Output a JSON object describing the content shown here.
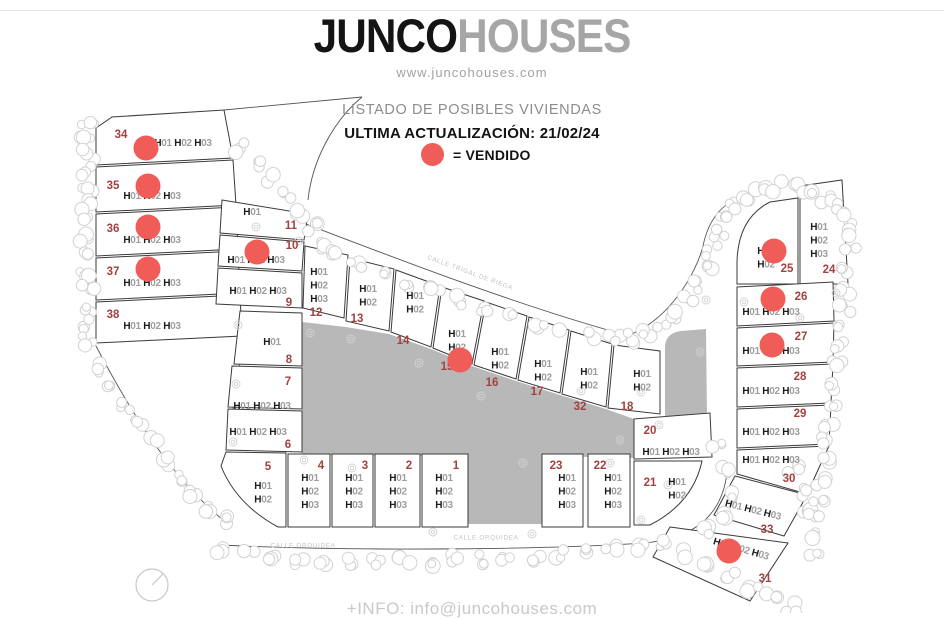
{
  "header": {
    "logo_primary": "JUNCO",
    "logo_secondary": "HOUSES",
    "website": "www.juncohouses.com",
    "listing_title": "LISTADO DE POSIBLES VIVIENDAS",
    "last_update": "ULTIMA ACTUALIZACIÓN: 21/02/24",
    "legend_label": "= VENDIDO"
  },
  "footer": {
    "info_text": "+INFO: info@juncohouses.com"
  },
  "colors": {
    "sold_dot": "#f05c57",
    "plot_number": "#a24140",
    "label_h": "#1b1b1b",
    "label_digits": "#9e9e9e",
    "outline": "#3a3a3a",
    "gray_area": "#b8b8b8",
    "trees": "#d2d2d2",
    "street": "#c2c2c2",
    "road": "#555555"
  },
  "map": {
    "street_labels": [
      {
        "text": "CALLE TRIGAL DE RIEGA",
        "x": 470,
        "y": 273,
        "rotate": 20
      },
      {
        "text": "CALLE ORQUIDEA",
        "x": 303,
        "y": 546,
        "rotate": 0
      },
      {
        "text": "CALLE ORQUIDEA",
        "x": 486,
        "y": 538,
        "rotate": 0
      }
    ],
    "gray_areas": [
      "M302,322 L346,327 L389,334 L431,349 L472,366 L516,381 L560,395 L606,409 L634,419 L634,458 L542,456 L542,524 L468,524 L468,456 L302,455 Z",
      "M665,346 Q666,333 681,331 L706,329 L707,416 L665,416 Z"
    ],
    "compass": {
      "cx": 152,
      "cy": 585,
      "r": 16
    },
    "plots": [
      {
        "n": "34",
        "houses": [
          "H01",
          "H02",
          "H03"
        ],
        "layout": "h",
        "poly": "96,128 112,117 224,110 233,158 96,165",
        "num": [
          121,
          135
        ],
        "label": [
          183,
          143
        ],
        "dot": [
          146,
          148
        ]
      },
      {
        "n": "35",
        "houses": [
          "H01",
          "H02",
          "H03"
        ],
        "layout": "h",
        "poly": "96,167 233,160 236,205 96,212",
        "num": [
          113,
          186
        ],
        "label": [
          152,
          196
        ],
        "dot": [
          148,
          186
        ]
      },
      {
        "n": "36",
        "houses": [
          "H01",
          "H02",
          "H03"
        ],
        "layout": "h",
        "poly": "96,214 236,207 238,249 96,256",
        "num": [
          113,
          229
        ],
        "label": [
          152,
          240
        ],
        "dot": [
          148,
          227
        ]
      },
      {
        "n": "37",
        "houses": [
          "H01",
          "H02",
          "H03"
        ],
        "layout": "h",
        "poly": "96,258 238,251 240,293 96,300",
        "num": [
          113,
          272
        ],
        "label": [
          152,
          283
        ],
        "dot": [
          148,
          269
        ]
      },
      {
        "n": "38",
        "houses": [
          "H01",
          "H02",
          "H03"
        ],
        "layout": "h",
        "poly": "96,302 240,295 242,336 96,343",
        "num": [
          113,
          315
        ],
        "label": [
          152,
          326
        ]
      },
      {
        "n": "11",
        "houses": [
          "H01"
        ],
        "layout": "h",
        "poly": "222,200 308,214 304,240 220,233",
        "num": [
          291,
          226
        ],
        "label": [
          252,
          212
        ]
      },
      {
        "n": "10",
        "houses": [
          "H01",
          "H02",
          "H03"
        ],
        "layout": "h",
        "poly": "220,235 304,242 302,271 218,266",
        "num": [
          292,
          246
        ],
        "label": [
          256,
          260
        ],
        "dot": [
          257,
          252
        ]
      },
      {
        "n": "9",
        "houses": [
          "H01",
          "H02",
          "H03"
        ],
        "layout": "h",
        "poly": "218,268 302,273 302,308 216,304",
        "num": [
          289,
          303
        ],
        "label": [
          258,
          291
        ]
      },
      {
        "n": "12",
        "houses": [
          "H01",
          "H02",
          "H03"
        ],
        "layout": "v",
        "poly": "305,246 348,255 344,318 303,308",
        "num": [
          316,
          313
        ],
        "label": [
          319,
          272
        ]
      },
      {
        "n": "13",
        "houses": [
          "H01",
          "H02"
        ],
        "layout": "v",
        "poly": "350,258 394,269 389,331 346,321",
        "num": [
          357,
          319
        ],
        "label": [
          368,
          289
        ]
      },
      {
        "n": "14",
        "houses": [
          "H01",
          "H02"
        ],
        "layout": "v",
        "poly": "396,270 440,286 431,347 391,332",
        "num": [
          403,
          341
        ],
        "label": [
          415,
          296
        ]
      },
      {
        "n": "15",
        "houses": [
          "H01",
          "H02"
        ],
        "layout": "v",
        "poly": "442,287 484,301 472,364 433,348",
        "num": [
          447,
          367
        ],
        "label": [
          457,
          334
        ],
        "dot": [
          460,
          360
        ]
      },
      {
        "n": "16",
        "houses": [
          "H01",
          "H02"
        ],
        "layout": "v",
        "poly": "486,302 527,316 516,379 474,365",
        "num": [
          492,
          383
        ],
        "label": [
          500,
          352
        ]
      },
      {
        "n": "17",
        "houses": [
          "H01",
          "H02"
        ],
        "layout": "v",
        "poly": "529,317 569,330 560,393 518,380",
        "num": [
          537,
          392
        ],
        "label": [
          543,
          364
        ]
      },
      {
        "n": "32",
        "houses": [
          "H01",
          "H02"
        ],
        "layout": "v",
        "poly": "571,331 612,344 606,407 562,394",
        "num": [
          580,
          407
        ],
        "label": [
          589,
          372
        ]
      },
      {
        "n": "18",
        "houses": [
          "H01",
          "H02"
        ],
        "layout": "v",
        "poly": "614,345 660,351 660,414 608,408",
        "num": [
          627,
          407
        ],
        "label": [
          642,
          374
        ]
      },
      {
        "n": "8",
        "houses": [
          "H01"
        ],
        "layout": "h",
        "poly": "240,311 302,313 302,366 234,364",
        "num": [
          289,
          360
        ],
        "label": [
          272,
          342
        ]
      },
      {
        "n": "7",
        "houses": [
          "H01",
          "H02",
          "H03"
        ],
        "layout": "h",
        "poly": "232,366 302,368 302,409 228,407",
        "num": [
          288,
          382
        ],
        "label": [
          262,
          406
        ]
      },
      {
        "n": "6",
        "houses": [
          "H01",
          "H02",
          "H03"
        ],
        "layout": "h",
        "poly": "228,409 302,411 302,452 226,450",
        "num": [
          288,
          445
        ],
        "label": [
          258,
          432
        ]
      },
      {
        "n": "5",
        "houses": [
          "H01",
          "H02"
        ],
        "layout": "v",
        "path": "M226,452 L286,453 L286,527 L278,527 Q236,504 221,466 Z",
        "num": [
          268,
          467
        ],
        "label": [
          263,
          486
        ]
      },
      {
        "n": "4",
        "houses": [
          "H01",
          "H02",
          "H03"
        ],
        "layout": "v",
        "poly": "288,454 330,454 330,527 288,527",
        "num": [
          321,
          466
        ],
        "label": [
          310,
          478
        ]
      },
      {
        "n": "3",
        "houses": [
          "H01",
          "H02",
          "H03"
        ],
        "layout": "v",
        "poly": "332,454 373,454 373,527 332,527",
        "num": [
          365,
          466
        ],
        "label": [
          354,
          478
        ]
      },
      {
        "n": "2",
        "houses": [
          "H01",
          "H02",
          "H03"
        ],
        "layout": "v",
        "poly": "375,454 420,454 420,527 375,527",
        "num": [
          409,
          466
        ],
        "label": [
          398,
          478
        ]
      },
      {
        "n": "1",
        "houses": [
          "H01",
          "H02",
          "H03"
        ],
        "layout": "v",
        "poly": "422,454 468,454 468,527 422,527",
        "num": [
          456,
          466
        ],
        "label": [
          444,
          478
        ]
      },
      {
        "n": "23",
        "houses": [
          "H01",
          "H02",
          "H03"
        ],
        "layout": "v",
        "poly": "542,454 583,454 583,527 542,527",
        "num": [
          556,
          466
        ],
        "label": [
          567,
          478
        ]
      },
      {
        "n": "22",
        "houses": [
          "H01",
          "H02",
          "H03"
        ],
        "layout": "v",
        "poly": "588,454 630,454 630,527 588,527",
        "num": [
          600,
          466
        ],
        "label": [
          613,
          478
        ]
      },
      {
        "n": "21",
        "houses": [
          "H01",
          "H02"
        ],
        "layout": "v",
        "path": "M634,461 L702,461 Q693,503 650,525 L634,525 Z",
        "num": [
          650,
          483
        ],
        "label": [
          677,
          482
        ]
      },
      {
        "n": "20",
        "houses": [
          "H01",
          "H02",
          "H03"
        ],
        "layout": "h",
        "poly": "634,419 710,413 712,457 634,459",
        "num": [
          650,
          431
        ],
        "label": [
          671,
          452
        ]
      },
      {
        "n": "24",
        "houses": [
          "H01",
          "H02",
          "H03"
        ],
        "layout": "v",
        "poly": "800,186 842,180 848,284 800,284",
        "num": [
          829,
          270
        ],
        "label": [
          819,
          227
        ]
      },
      {
        "n": "25",
        "houses": [
          "H01",
          "H02"
        ],
        "layout": "v",
        "path": "M737,262 Q738,218 770,202 L798,198 L798,284 L737,284 Z",
        "num": [
          787,
          269
        ],
        "label": [
          766,
          251
        ],
        "dot": [
          774,
          251
        ]
      },
      {
        "n": "26",
        "houses": [
          "H01",
          "H02",
          "H03"
        ],
        "layout": "h",
        "poly": "737,287 833,282 834,321 737,326",
        "num": [
          801,
          297
        ],
        "label": [
          771,
          312
        ],
        "dot": [
          773,
          299
        ]
      },
      {
        "n": "27",
        "houses": [
          "H01",
          "H02",
          "H03"
        ],
        "layout": "h",
        "poly": "737,328 834,323 833,362 737,366",
        "num": [
          801,
          337
        ],
        "label": [
          771,
          351
        ],
        "dot": [
          772,
          345
        ]
      },
      {
        "n": "28",
        "houses": [
          "H01",
          "H02",
          "H03"
        ],
        "layout": "h",
        "poly": "737,368 833,364 831,403 737,407",
        "num": [
          800,
          377
        ],
        "label": [
          771,
          391
        ]
      },
      {
        "n": "29",
        "houses": [
          "H01",
          "H02",
          "H03"
        ],
        "layout": "h",
        "poly": "737,409 831,405 829,444 737,448",
        "num": [
          800,
          414
        ],
        "label": [
          771,
          432
        ]
      },
      {
        "n": "30",
        "houses": [
          "H01",
          "H02",
          "H03"
        ],
        "layout": "h",
        "poly": "737,450 829,446 807,494 737,474",
        "num": [
          789,
          479
        ],
        "label": [
          771,
          460
        ]
      },
      {
        "n": "33",
        "houses": [
          "H01",
          "H02",
          "H03"
        ],
        "layout": "h",
        "poly": "735,476 807,495 784,536 714,515",
        "num": [
          767,
          530
        ],
        "label": [
          753,
          510
        ],
        "lrot": 14
      },
      {
        "n": "31",
        "houses": [
          "H01",
          "H02",
          "H03"
        ],
        "layout": "h",
        "poly": "670,527 788,543 750,601 653,557",
        "num": [
          765,
          579
        ],
        "label": [
          741,
          549
        ],
        "lrot": 16,
        "dot": [
          729,
          551
        ]
      }
    ]
  }
}
